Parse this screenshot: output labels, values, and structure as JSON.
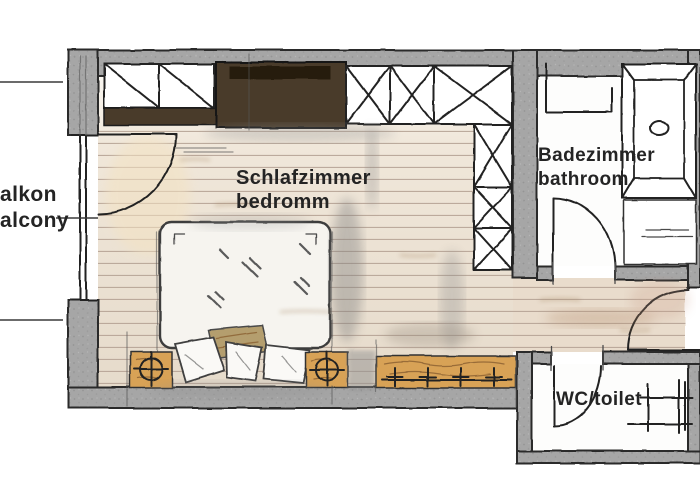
{
  "rooms": {
    "bedroom": {
      "label_de": "Schlafzimmer",
      "label_en": "bedromm"
    },
    "bathroom": {
      "label_de": "Badezimmer",
      "label_en": "bathroom"
    },
    "wc": {
      "label": "WC/toilet"
    },
    "balcony": {
      "label_de": "alkon",
      "label_en": "alcony"
    }
  },
  "colors": {
    "wall": "#a6a6a6",
    "line": "#222222",
    "label": "#242424",
    "floor": "#e8dccc",
    "floor-line": "#b3a092",
    "wood": "#d8a257",
    "cabinet": "#4a3a2b",
    "cabinet-dark": "#251b10",
    "paper": "#ffffff"
  }
}
